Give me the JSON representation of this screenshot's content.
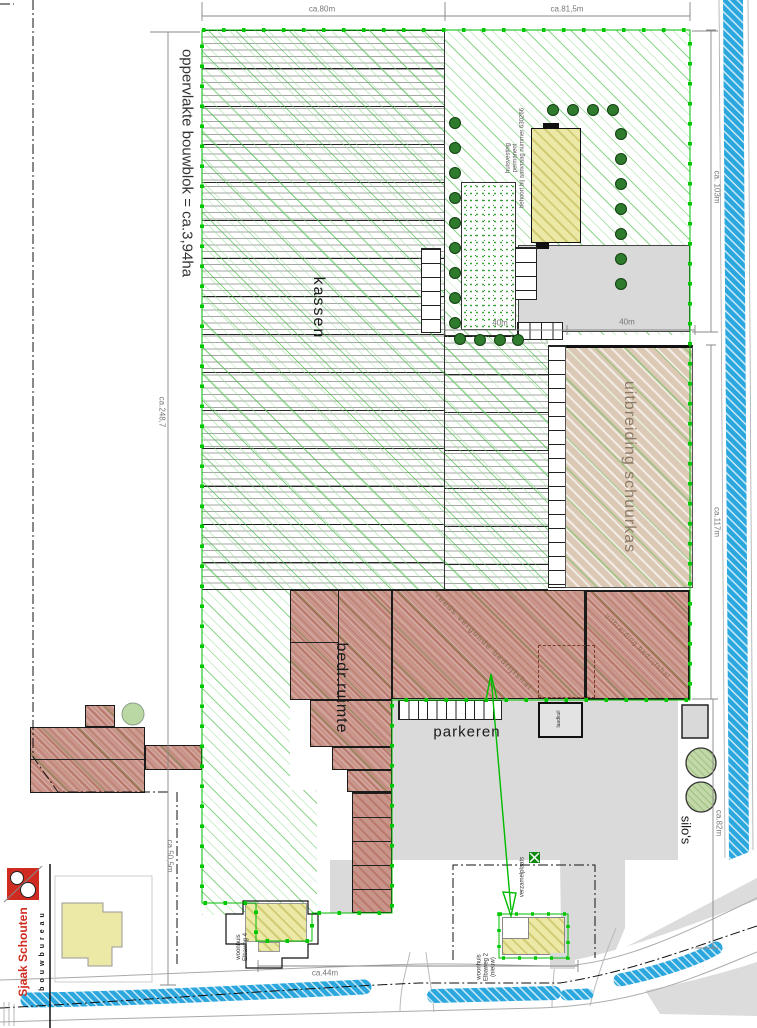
{
  "labels": {
    "area": "oppervlakte bouwblok = ca.3,94ha",
    "kassen": "kassen",
    "huisvesting": [
      "huisvesting",
      "permanent",
      "behoort bij aanvraag nummer 630266"
    ],
    "schuurkas": "uitbreiding schuurkas",
    "bedrijfsruimte": "bedr.ruimte",
    "vergunde_hal": "reeds vergunde bedrijfshal",
    "uitbreiding_hal": "uitbreiding bedrijfshal",
    "parkeren": "parkeren",
    "laadkuil": "laadkuil",
    "silos": "silo's",
    "verzamelplaats": "verzamelplaats",
    "woonhuis4": [
      "woonhuis",
      "Elbaweg 4"
    ],
    "woonhuis2": [
      "woonhuis",
      "Elbaweg 2",
      "(nieuw)"
    ]
  },
  "dimensions": {
    "top_left": "ca.80m",
    "top_right": "ca.81,5m",
    "right_upper": "ca. 103m",
    "right_mid": "ca.117m",
    "left_total": "ca.248,7",
    "forty_a": "40m",
    "forty_b": "40m",
    "bottom_width": "ca.44m",
    "left_lower": "ca.50,5m",
    "right_lower": "ca.82m"
  },
  "logo": {
    "firm": "bouwbureau",
    "name": "Sjaak Schouten"
  },
  "colors": {
    "boundary_green": "#00bb00",
    "water_blue": "#2ba7de",
    "hall_red": "#c9948a",
    "schuurkas_tan": "#dcc9b5",
    "house_yellow": "#ece8a5",
    "bush_green": "#2e7b2e"
  }
}
